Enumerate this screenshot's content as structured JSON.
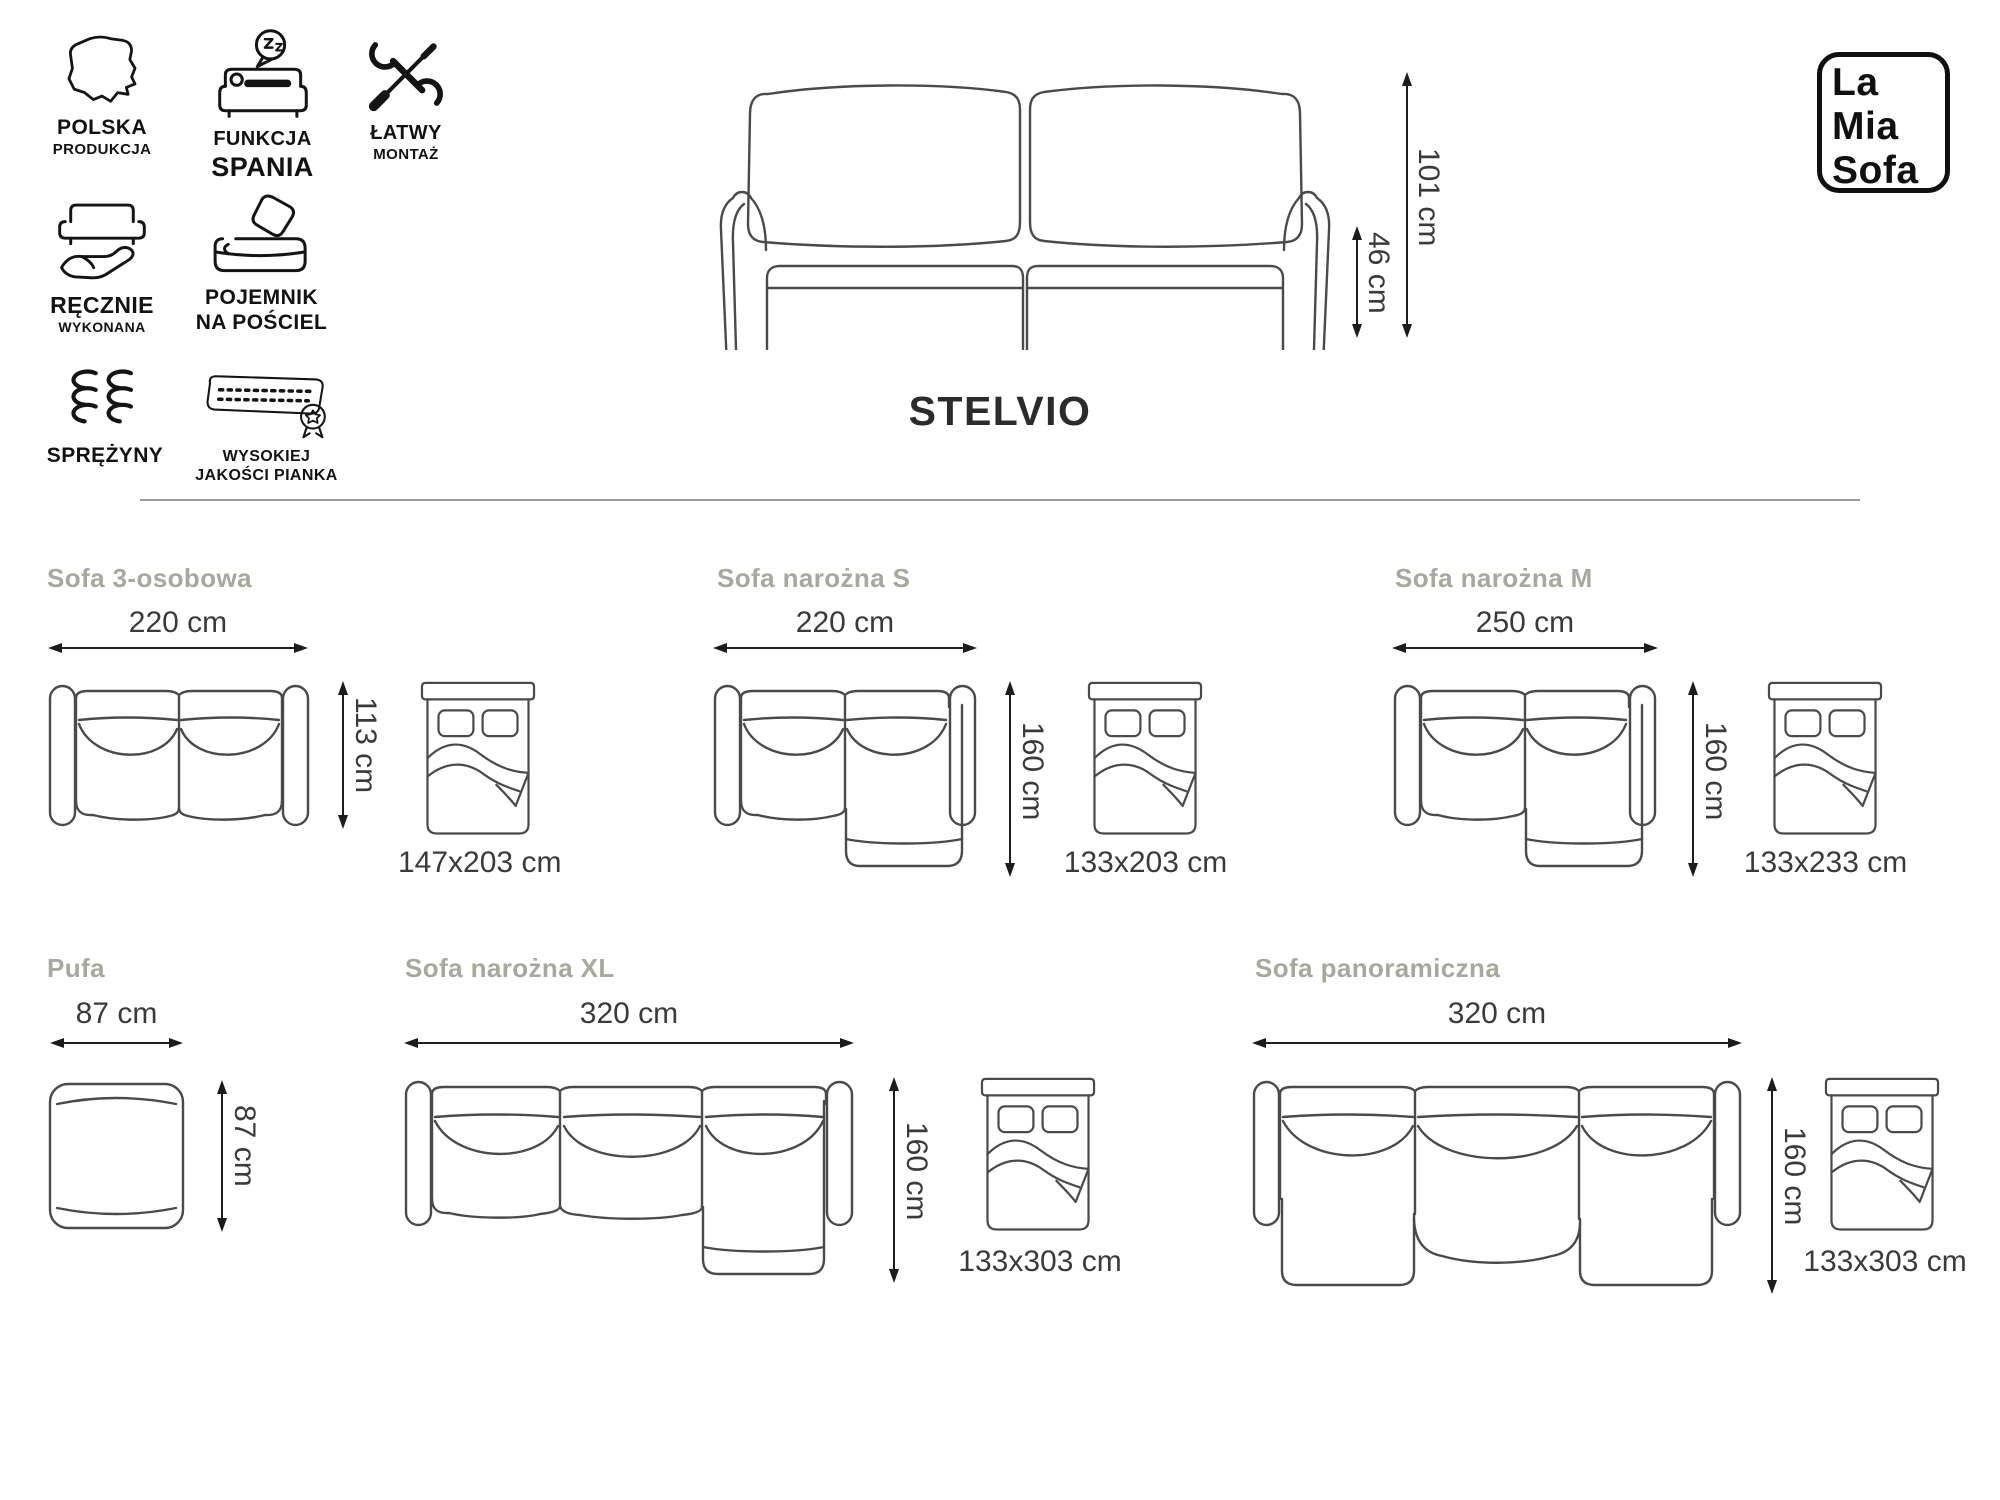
{
  "brand": {
    "line1": "La",
    "line2": "Mia",
    "line3": "Sofa"
  },
  "product_title": "STELVIO",
  "features": [
    {
      "icon": "poland-map-icon",
      "line1": "POLSKA",
      "line2": "PRODUKCJA"
    },
    {
      "icon": "sleep-function-icon",
      "line1": "FUNKCJA",
      "line2": "SPANIA"
    },
    {
      "icon": "easy-assembly-tools-icon",
      "line1": "ŁATWY",
      "line2": "MONTAŻ"
    },
    {
      "icon": "handmade-icon",
      "line1": "RĘCZNIE",
      "line2": "WYKONANA"
    },
    {
      "icon": "bedding-container-icon",
      "line1": "POJEMNIK",
      "line2": "NA POŚCIEL"
    },
    {
      "icon": "springs-icon",
      "line1": "SPRĘŻYNY",
      "line2": ""
    },
    {
      "icon": "quality-foam-icon",
      "line1": "WYSOKIEJ",
      "line2": "JAKOŚCI PIANKA"
    }
  ],
  "main_sofa": {
    "height_total": "101 cm",
    "height_seat": "46 cm"
  },
  "variants": [
    {
      "name": "Sofa 3-osobowa",
      "width": "220 cm",
      "depth": "113 cm",
      "bed": "147x203 cm"
    },
    {
      "name": "Sofa narożna S",
      "width": "220 cm",
      "depth": "160 cm",
      "bed": "133x203 cm"
    },
    {
      "name": "Sofa narożna M",
      "width": "250 cm",
      "depth": "160 cm",
      "bed": "133x233 cm"
    },
    {
      "name": "Pufa",
      "width": "87 cm",
      "depth": "87 cm",
      "bed": null
    },
    {
      "name": "Sofa narożna XL",
      "width": "320 cm",
      "depth": "160 cm",
      "bed": "133x303 cm"
    },
    {
      "name": "Sofa panoramiczna",
      "width": "320 cm",
      "depth": "160 cm",
      "bed": "133x303 cm"
    }
  ],
  "colors": {
    "heading": "#a8a89c",
    "dimension_text": "#3a3a3a",
    "line_art": "#4a4a4a",
    "ink": "#111111",
    "divider": "#9a9a9a"
  }
}
